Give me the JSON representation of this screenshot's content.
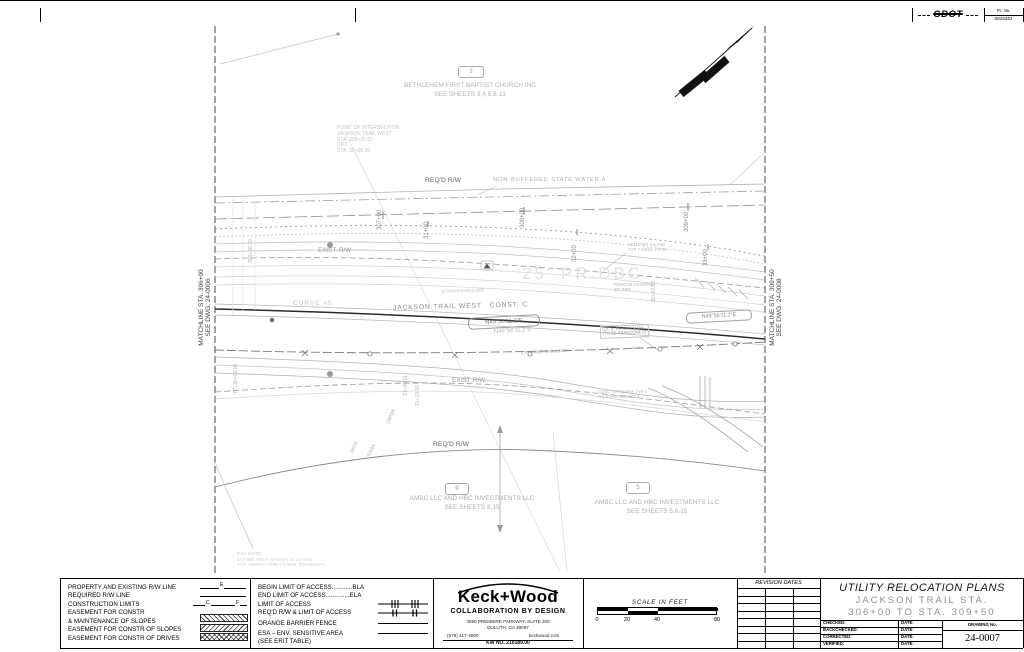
{
  "page": {
    "pi_label": "P.I. No.",
    "pi_number": "0016351",
    "logo": "GDOT"
  },
  "plan": {
    "matchline_left_l1": "MATCHLINE STA. 306+00",
    "matchline_left_l2": "SEE DWG. 24-0006",
    "matchline_right_l1": "MATCHLINE STA. 309+50",
    "matchline_right_l2": "SEE DWG. 24-0008",
    "parcel2": {
      "num": "2",
      "name": "BETHLEHEM FIRST BAPTIST CHURCH INC",
      "sheets": "SEE SHEETS 3,4,5,8,13"
    },
    "parcel9": {
      "num": "9",
      "name": "AMBC LLC AND HBC INVESTMENTS LLC",
      "sheets": "SEE SHEETS 8,15"
    },
    "parcel5": {
      "num": "5",
      "name": "AMBC LLC AND HBC INVESTMENTS LLC",
      "sheets": "SEE SHEETS 5,6,15"
    },
    "poi": {
      "l1": "POINT OF INTERSECTION",
      "l2": "JACKSON TRAIL WEST",
      "l3": "STA. 308+25.02",
      "l4": "DR2",
      "l5": "STA. 30+00.00"
    },
    "stations": [
      "307+00",
      "31+00",
      "308+00",
      "309+00",
      "32+00",
      "33+00"
    ],
    "labels": {
      "reqd_rw_top": "REQ'D R/W",
      "water": "NON-BUFFERED STATE WATER A",
      "exist_rw_top": "EXIST. R/W",
      "pr_dbc": "25' PR DBC",
      "curve": "CURVE #5",
      "road": "JACKSON TRAIL WEST   CONST. C",
      "bearing": "N49°56'11.2\"E",
      "bearing2": "N49°56'11.2\"E",
      "bearing3": "N49°56'11.2\"E",
      "gas1": "EX. 4\" PE GAS MAIN",
      "gas2": "(TO BE ABANDONED)",
      "splitter1": "SPLITTER ISLAND",
      "splitter2": "TYP 7 CONC FACE",
      "remove1": "REMOVE EXISTING",
      "remove2": "18\" PIPE",
      "shoulder_top": "6' PAVED SHOULDER",
      "shoulder_ep": "E.P. PAVED SHOULDER",
      "exist_rw_bottom": "EXIST. R/W",
      "reqd_rw_bottom": "REQ'D R/W",
      "driveway1": "CONC DRIVEWAY TYP 2",
      "driveway2": "GA STANDARD 9013",
      "marker_4440": "-4440-",
      "sta_3282": "32+82.53",
      "pot": "306+38.30",
      "pc": "PC 30+00.00",
      "pc2": "31+05.61",
      "pc3": "31+19.50",
      "d1": "DB838",
      "d2": "D658",
      "d3": "DC694"
    },
    "esa_note": [
      "ESA NOTE:",
      "ENTIRE AREA SHOWN IS WITHIN",
      "THE 'SMITH FAMILY FARM' BOUNDARY."
    ]
  },
  "legend_left": {
    "items": [
      {
        "label": "PROPERTY AND EXISTING R/W LINE"
      },
      {
        "label": "REQUIRED R/W LINE"
      },
      {
        "label": "CONSTRUCTION LIMITS"
      },
      {
        "label": "EASEMENT FOR CONSTR"
      },
      {
        "label": "& MAINTENANCE OF SLOPES"
      },
      {
        "label": "EASEMENT FOR CONSTR OF SLOPES"
      },
      {
        "label": "EASEMENT FOR CONSTR OF DRIVES"
      }
    ],
    "sym_e": "E",
    "sym_c": "C",
    "sym_f": "F"
  },
  "legend_right": {
    "items": [
      "BEGIN LIMIT OF ACCESS............BLA",
      "END LIMIT OF ACCESS..............ELA",
      "LIMIT OF ACCESS",
      "REQ'D R/W & LIMIT OF ACCESS",
      "ORANGE BARRIER FENCE",
      "ESA – ENV. SENSITIVE AREA",
      "(SEE ERIT TABLE)"
    ]
  },
  "firm": {
    "name": "Keck+Wood",
    "tagline": "COLLABORATION BY DESIGN",
    "address1": "3090 PREMIERE PARKWAY, SUITE 200",
    "address2": "DULUTH, GA  30097",
    "phone": "(678) 417-4000",
    "website": "keckwood.com",
    "kw_no": "KW NO.  210189.00"
  },
  "scale": {
    "title": "SCALE IN FEET",
    "t0": "0",
    "t20": "20",
    "t40": "40",
    "t80": "80"
  },
  "revision": {
    "header": "REVISION DATES"
  },
  "titleblock": {
    "title": "UTILITY RELOCATION PLANS",
    "sub1": "JACKSON TRAIL STA.",
    "sub2": "306+00 TO STA. 309+50",
    "rows": [
      {
        "l": "CHECKED:",
        "d": "DATE:"
      },
      {
        "l": "BACKCHECKED:",
        "d": "DATE:"
      },
      {
        "l": "CORRECTED:",
        "d": "DATE:"
      },
      {
        "l": "VERIFIED:",
        "d": "DATE:"
      }
    ],
    "drawing_label": "DRAWING No.",
    "drawing_no": "24-0007"
  }
}
